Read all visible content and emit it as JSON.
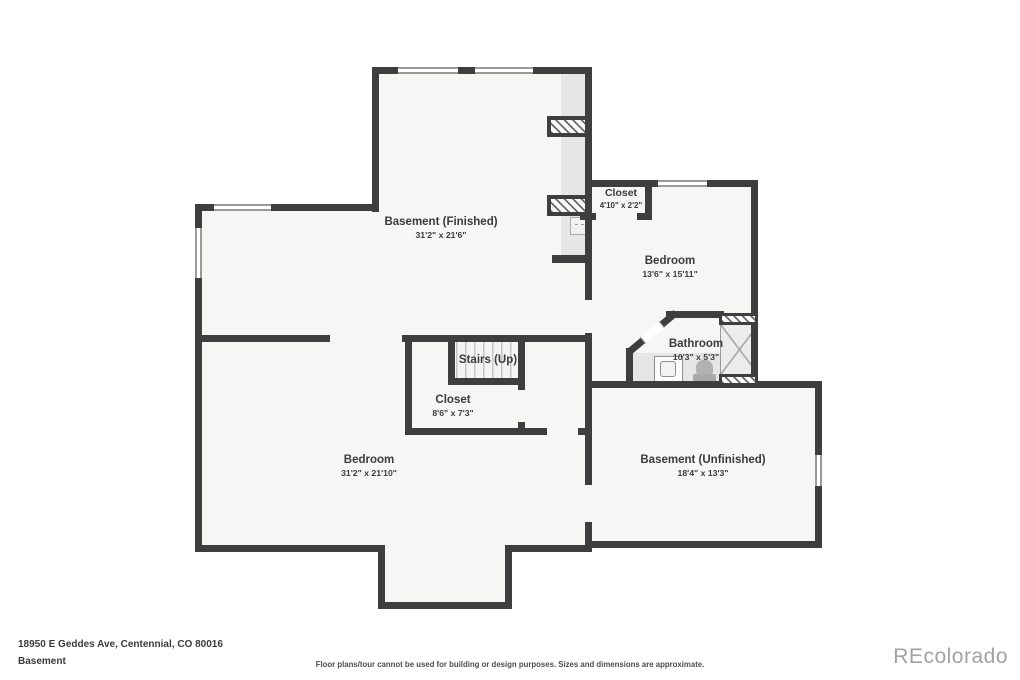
{
  "plan": {
    "rooms": [
      {
        "id": "basement-finished",
        "label": "Basement (Finished)",
        "dims": "31'2\" x 21'6\""
      },
      {
        "id": "closet-upper",
        "label": "Closet",
        "dims": "4'10\" x 2'2\""
      },
      {
        "id": "bedroom-upper",
        "label": "Bedroom",
        "dims": "13'6\" x 15'11\""
      },
      {
        "id": "bathroom",
        "label": "Bathroom",
        "dims": "10'3\" x 5'3\""
      },
      {
        "id": "stairs",
        "label": "Stairs (Up)",
        "dims": ""
      },
      {
        "id": "closet-lower",
        "label": "Closet",
        "dims": "8'6\" x 7'3\""
      },
      {
        "id": "bedroom-lower",
        "label": "Bedroom",
        "dims": "31'2\" x 21'10\""
      },
      {
        "id": "basement-unfinished",
        "label": "Basement (Unfinished)",
        "dims": "18'4\" x 13'3\""
      }
    ]
  },
  "footer": {
    "address": "18950 E Geddes Ave, Centennial, CO 80016",
    "level": "Basement",
    "disclaimer": "Floor plans/tour cannot be used for building or design purposes. Sizes and dimensions are approximate.",
    "watermark": "REcolorado"
  },
  "colors": {
    "wall": "#3e3e3e",
    "room_fill": "#f6f6f5",
    "shade": "#e6e6e6",
    "text": "#3b3b3b",
    "watermark": "#a2a2a2"
  }
}
